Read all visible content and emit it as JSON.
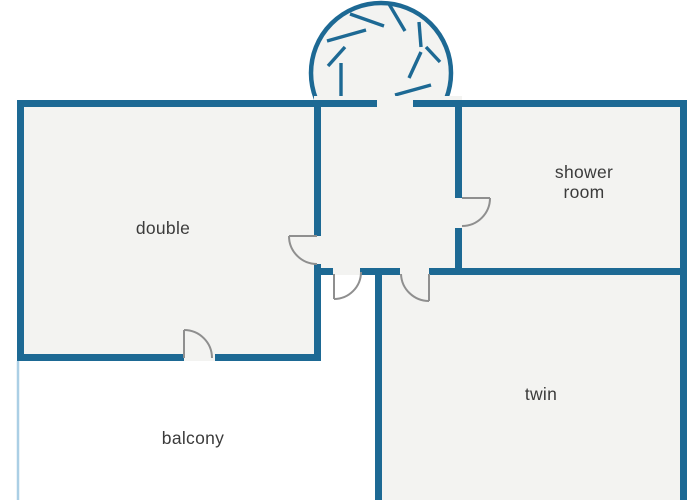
{
  "plan": {
    "title": "apartment floor plan",
    "rooms": [
      {
        "id": "double",
        "label": "double"
      },
      {
        "id": "shower-room",
        "label": "shower room"
      },
      {
        "id": "twin",
        "label": "twin"
      },
      {
        "id": "balcony",
        "label": "balcony"
      }
    ],
    "features": {
      "staircase": "spiral staircase",
      "door_count": 5
    },
    "colors": {
      "wall": "#1d6994",
      "room_fill": "#f3f3f1",
      "door": "#8f8f8f",
      "balcony_outline": "#abcfe5",
      "label_text": "#3b3b3b",
      "background": "#ffffff"
    }
  }
}
